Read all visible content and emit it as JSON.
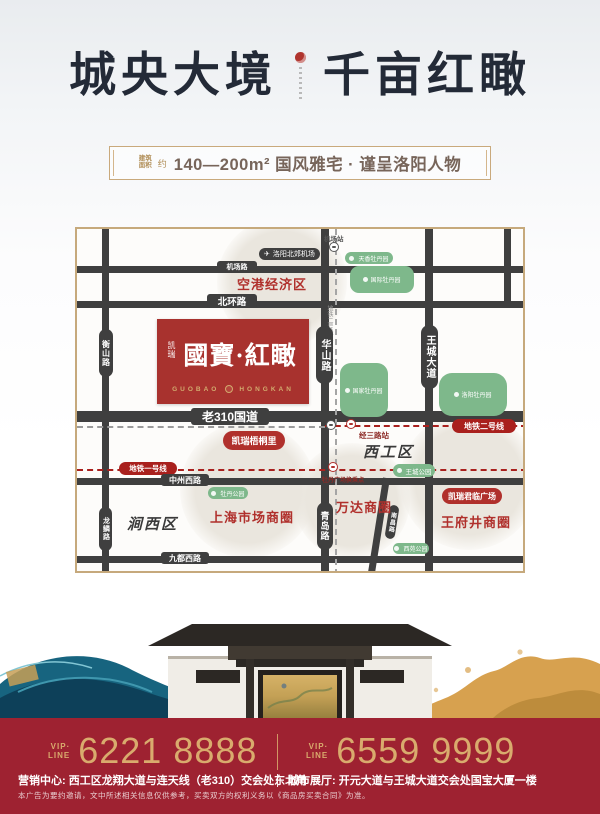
{
  "poster": {
    "title": {
      "left": "城央大境",
      "right": "千亩红瞰"
    },
    "banner": {
      "area_label_line1": "建筑",
      "area_label_line2": "面积",
      "approx": "约",
      "text": "140—200m² 国风雅宅 · 谨呈洛阳人物"
    }
  },
  "map": {
    "project": {
      "brand": "凯瑞",
      "name": "國寶·紅瞰",
      "latin_left": "GUOBAO",
      "latin_right": "HONGKAN"
    },
    "airport": {
      "station_label": "机场站",
      "airport_label": "洛阳北郊机场"
    },
    "roads": {
      "jichang": "机场路",
      "beihuan": "北环路",
      "g310": "老310国道",
      "zhongzhou_west": "中州西路",
      "jiudu_west": "九都西路",
      "hengshan": "衡山路",
      "longlin": "龙鳞路",
      "huashan": "华山路",
      "qingdao": "青岛路",
      "wangcheng_ave": "王城大道",
      "nanchang": "南昌路"
    },
    "metro": {
      "line2_label": "地铁二号线",
      "line1_label": "地铁一号线",
      "line2_note": "地铁二号线（在建中）",
      "jingsan_station": "经三路站",
      "mudan_transfer": "牡丹广场换乘点"
    },
    "zones": {
      "konggang": "空港经济区",
      "xigong": "西工区",
      "jianxi": "涧西区",
      "shanghai_market": "上海市场商圈",
      "wanda": "万达商圈",
      "wangfujing": "王府井商圈"
    },
    "parks": {
      "tianxiang": "天香牡丹园",
      "international": "国际牡丹园",
      "national": "国家牡丹园",
      "luoyang": "洛阳牡丹园",
      "wangcheng_park": "王城公园",
      "mudan_park": "牡丹公园",
      "xiyuan_park": "西苑公园"
    },
    "landmarks": {
      "wutongli": "凯瑞梧桐里",
      "junlin_plaza": "凯瑞君临广场"
    }
  },
  "footer": {
    "vip": "VIP·",
    "line": "LINE",
    "phone_left": "6221 8888",
    "phone_right": "6559 9999",
    "address_left": "营销中心: 西工区龙翔大道与连天线（老310）交会处东北角",
    "address_right": "城市展厅: 开元大道与王城大道交会处国宝大厦一楼",
    "disclaimer": "本广告为要约邀请，文中所述相关信息仅供参考，买卖双方的权利义务以《商品房买卖合同》为准。"
  },
  "colors": {
    "accent_red": "#b0302c",
    "footer_red": "#9e2231",
    "gold": "#c9a46b",
    "road_dark": "#3f3f3f",
    "park_green": "#7eb88b"
  }
}
